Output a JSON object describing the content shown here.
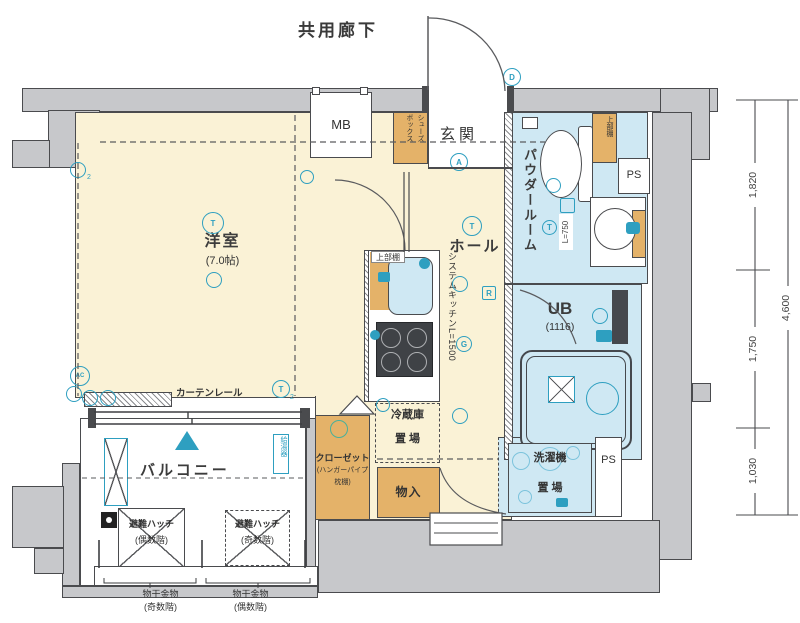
{
  "labels": {
    "corridor": "共用廊下",
    "mb": "MB",
    "shoe_box": "シューズ\nボックス",
    "genkan": "玄関",
    "powder_room": "パウダールーム",
    "upper_shelf_powder": "上部棚",
    "ps_top": "PS",
    "ps_bottom": "PS",
    "l750": "L=750",
    "ub": "UB",
    "ub_size": "(1116)",
    "laundry_l1": "洗濯機",
    "laundry_l2": "置 場",
    "room": "洋室",
    "room_size": "(7.0帖)",
    "hall": "ホール",
    "upper_shelf_kitchen": "上部棚",
    "system_kitchen": "システムキッチンL=1500",
    "fridge_l1": "冷蔵庫",
    "fridge_l2": "置 場",
    "closet_l1": "クローゼット",
    "closet_l2": "(ハンガーパイプ",
    "closet_l3": "枕棚)",
    "storage": "物入",
    "curtain_rail": "カーテンレール",
    "balcony": "バルコニー",
    "water_heater": "給湯器",
    "hatch_even_l1": "避難ハッチ",
    "hatch_even_l2": "(偶数階)",
    "hatch_odd_l1": "避難ハッチ",
    "hatch_odd_l2": "(奇数階)",
    "drying_odd_l1": "物干金物",
    "drying_odd_l2": "(奇数階)",
    "drying_even_l1": "物干金物",
    "drying_even_l2": "(偶数階)"
  },
  "dimensions": {
    "d1": "1,820",
    "d2": "1,750",
    "d3": "1,030",
    "total": "4,600"
  },
  "symbols": {
    "t": "T",
    "a": "A",
    "d": "D",
    "g": "G",
    "r": "R",
    "ac": "AC",
    "two": "2"
  },
  "colors": {
    "wall": "#c7c8cb",
    "floor": "#faf2d6",
    "wet": "#cfe8f3",
    "storage": "#e4b269",
    "accent": "#2e9fc0",
    "line": "#4a4b4e"
  }
}
